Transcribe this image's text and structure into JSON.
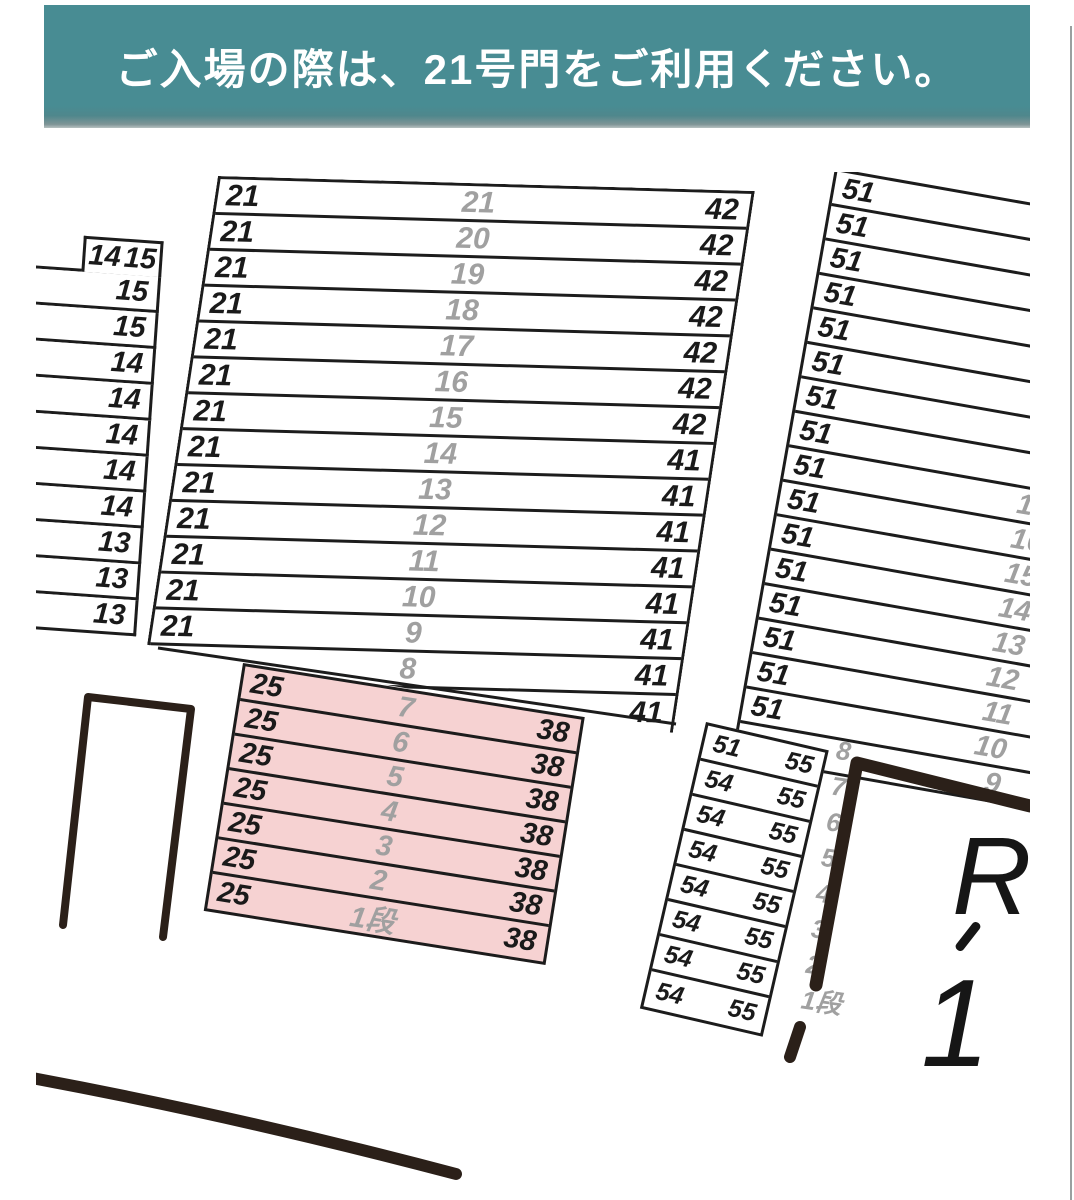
{
  "banner": {
    "text": "ご入場の際は、21号門をご利用ください。",
    "bg_color": "#488c93",
    "text_color": "#ffffff"
  },
  "landmark_label": {
    "top": "R",
    "bottom": "1"
  },
  "colors": {
    "pink_fill": "#f6d2d2",
    "line": "#1c1c1c",
    "grey_number": "#a0a0a0",
    "thick_line": "#2b2019"
  },
  "blocks": {
    "main_section": {
      "rows": [
        {
          "left": "21",
          "mid": "21",
          "right": "42"
        },
        {
          "left": "21",
          "mid": "20",
          "right": "42"
        },
        {
          "left": "21",
          "mid": "19",
          "right": "42"
        },
        {
          "left": "21",
          "mid": "18",
          "right": "42"
        },
        {
          "left": "21",
          "mid": "17",
          "right": "42"
        },
        {
          "left": "21",
          "mid": "16",
          "right": "42"
        },
        {
          "left": "21",
          "mid": "15",
          "right": "42"
        },
        {
          "left": "21",
          "mid": "14",
          "right": "41"
        },
        {
          "left": "21",
          "mid": "13",
          "right": "41"
        },
        {
          "left": "21",
          "mid": "12",
          "right": "41"
        },
        {
          "left": "21",
          "mid": "11",
          "right": "41"
        },
        {
          "left": "21",
          "mid": "10",
          "right": "41"
        },
        {
          "left": "21",
          "mid": "9",
          "right": "41"
        },
        {
          "left": "",
          "mid": "8",
          "right": "41"
        },
        {
          "left": "",
          "mid": "",
          "right": "41"
        }
      ]
    },
    "highlighted_section": {
      "rows": [
        {
          "left": "25",
          "mid": "7",
          "right": "38"
        },
        {
          "left": "25",
          "mid": "6",
          "right": "38"
        },
        {
          "left": "25",
          "mid": "5",
          "right": "38"
        },
        {
          "left": "25",
          "mid": "4",
          "right": "38"
        },
        {
          "left": "25",
          "mid": "3",
          "right": "38"
        },
        {
          "left": "25",
          "mid": "2",
          "right": "38"
        },
        {
          "left": "25",
          "mid": "1段",
          "right": "38"
        }
      ]
    },
    "left_partial_section": {
      "rows": [
        {
          "left": "14",
          "right": "15",
          "boxed": true
        },
        {
          "right": "15"
        },
        {
          "right": "15"
        },
        {
          "right": "14"
        },
        {
          "right": "14"
        },
        {
          "right": "14"
        },
        {
          "right": "14"
        },
        {
          "right": "14"
        },
        {
          "right": "13"
        },
        {
          "right": "13"
        },
        {
          "right": "13"
        }
      ]
    },
    "right_section": {
      "rows": [
        {
          "left": "51",
          "mid": ""
        },
        {
          "left": "51",
          "mid": ""
        },
        {
          "left": "51",
          "mid": ""
        },
        {
          "left": "51",
          "mid": ""
        },
        {
          "left": "51",
          "mid": ""
        },
        {
          "left": "51",
          "mid": ""
        },
        {
          "left": "51",
          "mid": ""
        },
        {
          "left": "51",
          "mid": ""
        },
        {
          "left": "51",
          "mid": "17"
        },
        {
          "left": "51",
          "mid": "16"
        },
        {
          "left": "51",
          "mid": "15"
        },
        {
          "left": "51",
          "mid": "14"
        },
        {
          "left": "51",
          "mid": "13"
        },
        {
          "left": "51",
          "mid": "12"
        },
        {
          "left": "51",
          "mid": "11"
        },
        {
          "left": "51",
          "mid": "10"
        },
        {
          "left": "",
          "mid": "9"
        }
      ]
    },
    "corner_section": {
      "rows": [
        {
          "left": "51",
          "right": "55"
        },
        {
          "left": "54",
          "right": "55"
        },
        {
          "left": "54",
          "right": "55"
        },
        {
          "left": "54",
          "right": "55"
        },
        {
          "left": "54",
          "right": "55"
        },
        {
          "left": "54",
          "right": "55"
        },
        {
          "left": "54",
          "right": "55"
        },
        {
          "left": "54",
          "right": "55"
        }
      ],
      "side_row_numbers": [
        "8",
        "7",
        "6",
        "5",
        "4",
        "3",
        "2",
        "1段"
      ]
    }
  }
}
